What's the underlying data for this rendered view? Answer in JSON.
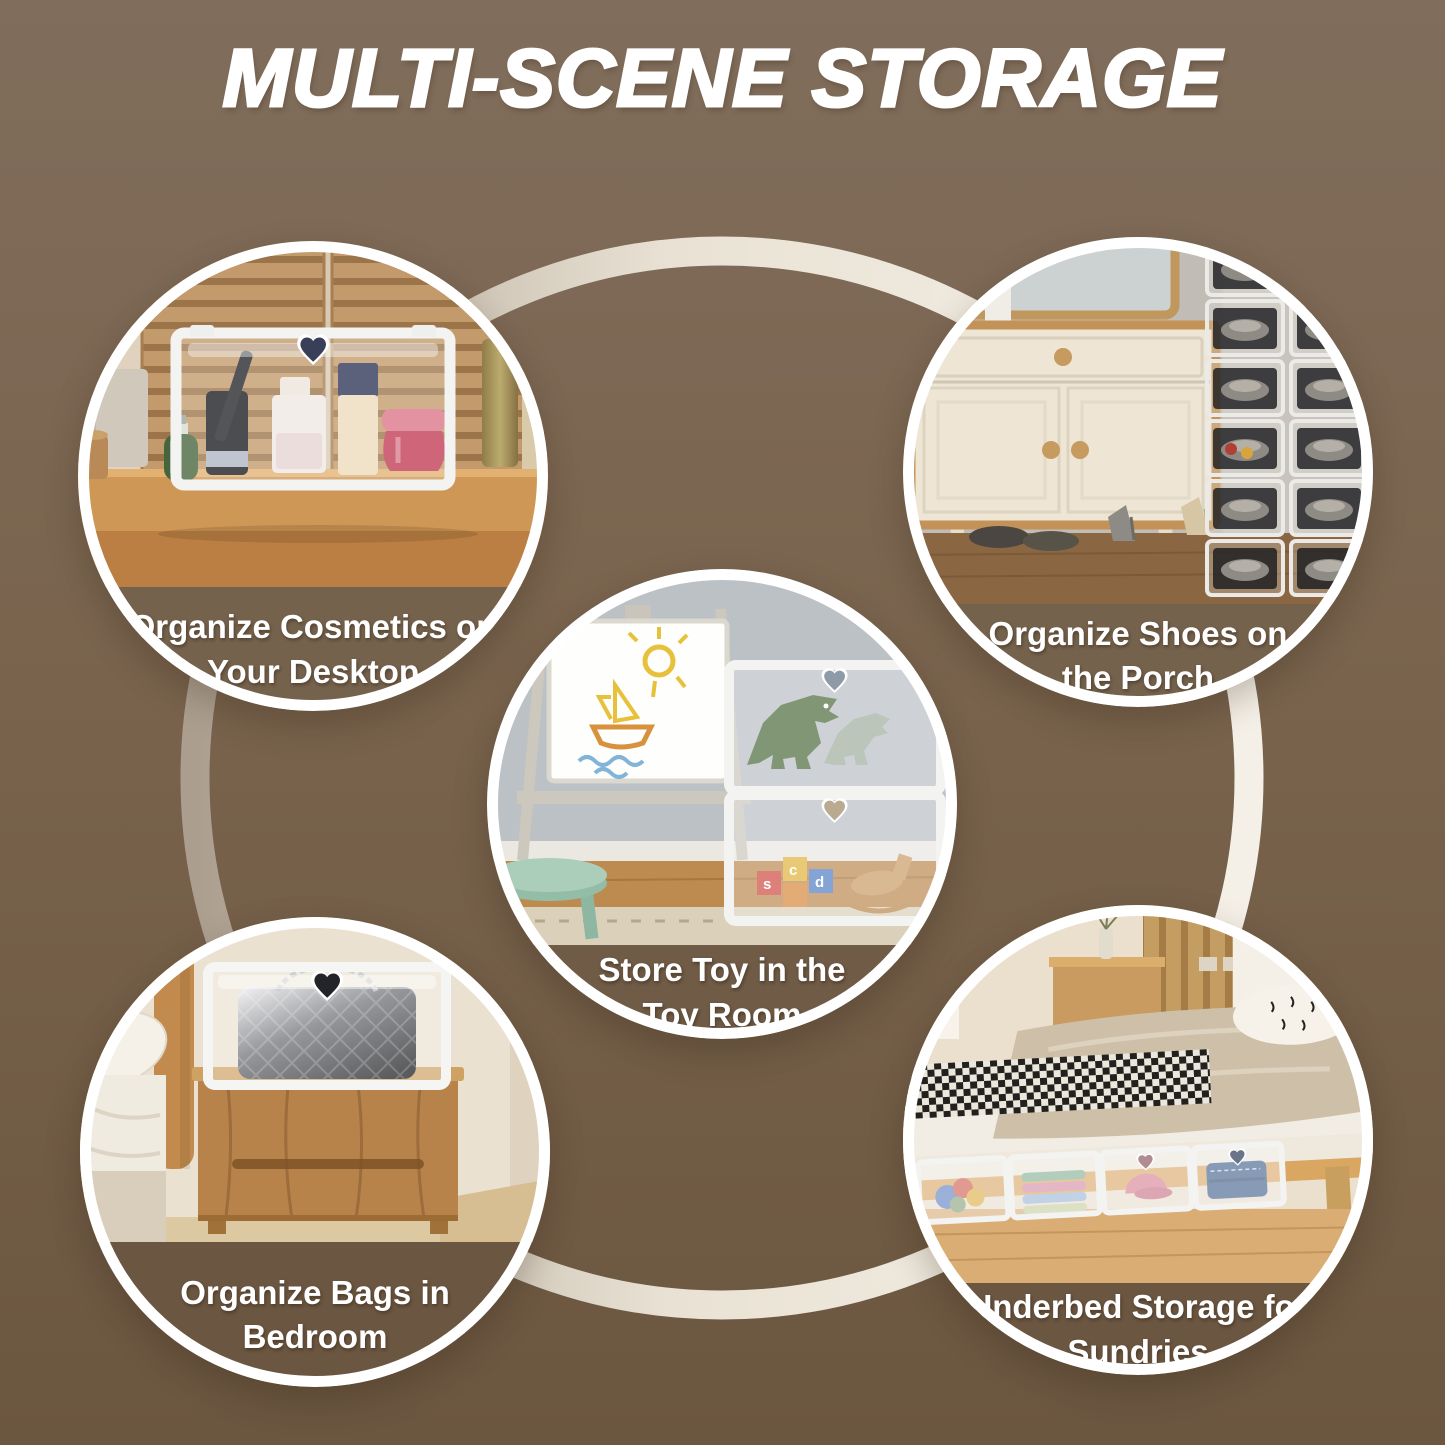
{
  "page": {
    "title": "MULTI-SCENE STORAGE",
    "title_color": "#ffffff",
    "background_top": "#806d5b",
    "background_bottom": "#6b5640",
    "ring_color_dark": "#ab9e8e",
    "ring_color_light": "#f5f0e7",
    "circle_border_color": "#ffffff",
    "caption_color": "#ffffff"
  },
  "scenes": [
    {
      "id": "cosmetics",
      "photo_alt": "clear storage box with cosmetics on a wooden desktop",
      "caption": [
        "Organize Cosmetics on",
        "Your Desktop"
      ]
    },
    {
      "id": "shoes",
      "photo_alt": "stacked clear shoe boxes beside a cream cabinet on the porch",
      "caption": [
        "Organize Shoes on",
        "the Porch"
      ]
    },
    {
      "id": "toys",
      "photo_alt": "stacked clear boxes holding dinosaur toys and blocks in a toy room",
      "caption": [
        "Store Toy in the",
        "Toy Room"
      ]
    },
    {
      "id": "bags",
      "photo_alt": "clear box with a quilted handbag on a bedroom nightstand",
      "caption": [
        "Organize Bags in",
        "Bedroom"
      ]
    },
    {
      "id": "underbed",
      "photo_alt": "clear storage boxes with sundries under a wooden bed",
      "caption": [
        "Underbed Storage for",
        "Sundries"
      ]
    }
  ]
}
